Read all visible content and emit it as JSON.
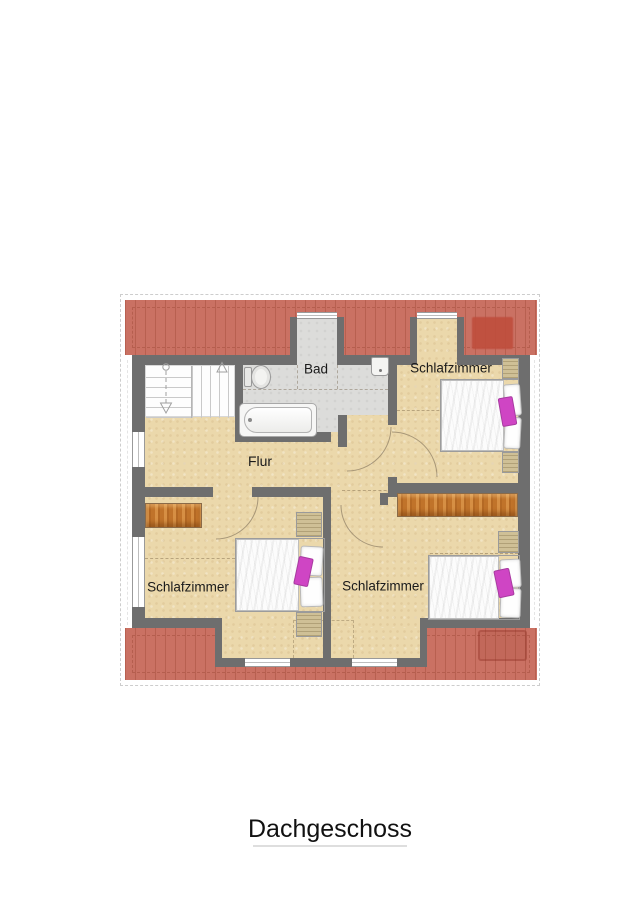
{
  "title": {
    "text": "Dachgeschoss"
  },
  "rooms": {
    "bad": "Bad",
    "flur": "Flur",
    "schlafzimmer_top_right": "Schlafzimmer",
    "schlafzimmer_bottom_left": "Schlafzimmer",
    "schlafzimmer_bottom_right": "Schlafzimmer"
  },
  "colors": {
    "roof": "#ca7163",
    "roof_hatch": "#a5503d",
    "roof_skylight": "#bf4e3d",
    "floor": "#ebd8ab",
    "bathroom_floor": "#dcdcda",
    "wall": "#6e6e6e",
    "wood": "#c0732a",
    "accent_pink": "#cf45c4"
  }
}
